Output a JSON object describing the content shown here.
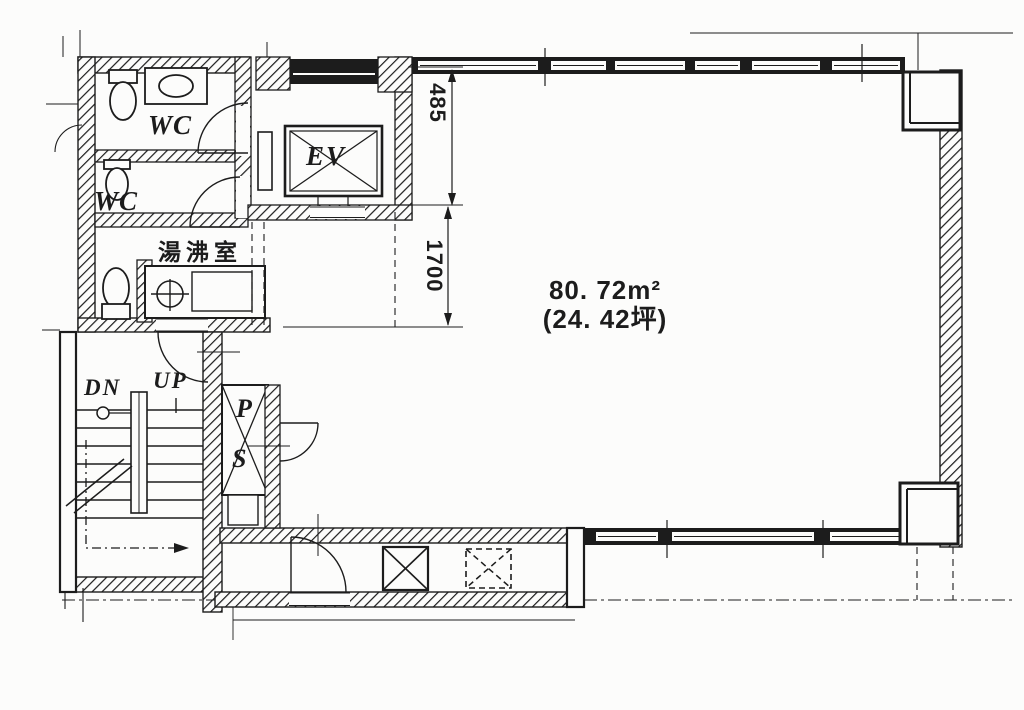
{
  "plan": {
    "type": "architectural-floor-plan",
    "area": {
      "m2": "80. 72m²",
      "tsubo": "(24. 42坪)"
    },
    "dimensions": {
      "v485": "485",
      "v1700": "1700"
    },
    "labels": {
      "wc_upper": "WC",
      "wc_lower": "WC",
      "kitchenette": "湯沸室",
      "elevator": "EV",
      "stairs_down": "DN",
      "stairs_up": "UP",
      "pipe_shaft_p": "P",
      "pipe_shaft_s": "S"
    },
    "colors": {
      "ink": "#1c1c1c",
      "paper": "#fcfcfb"
    }
  }
}
